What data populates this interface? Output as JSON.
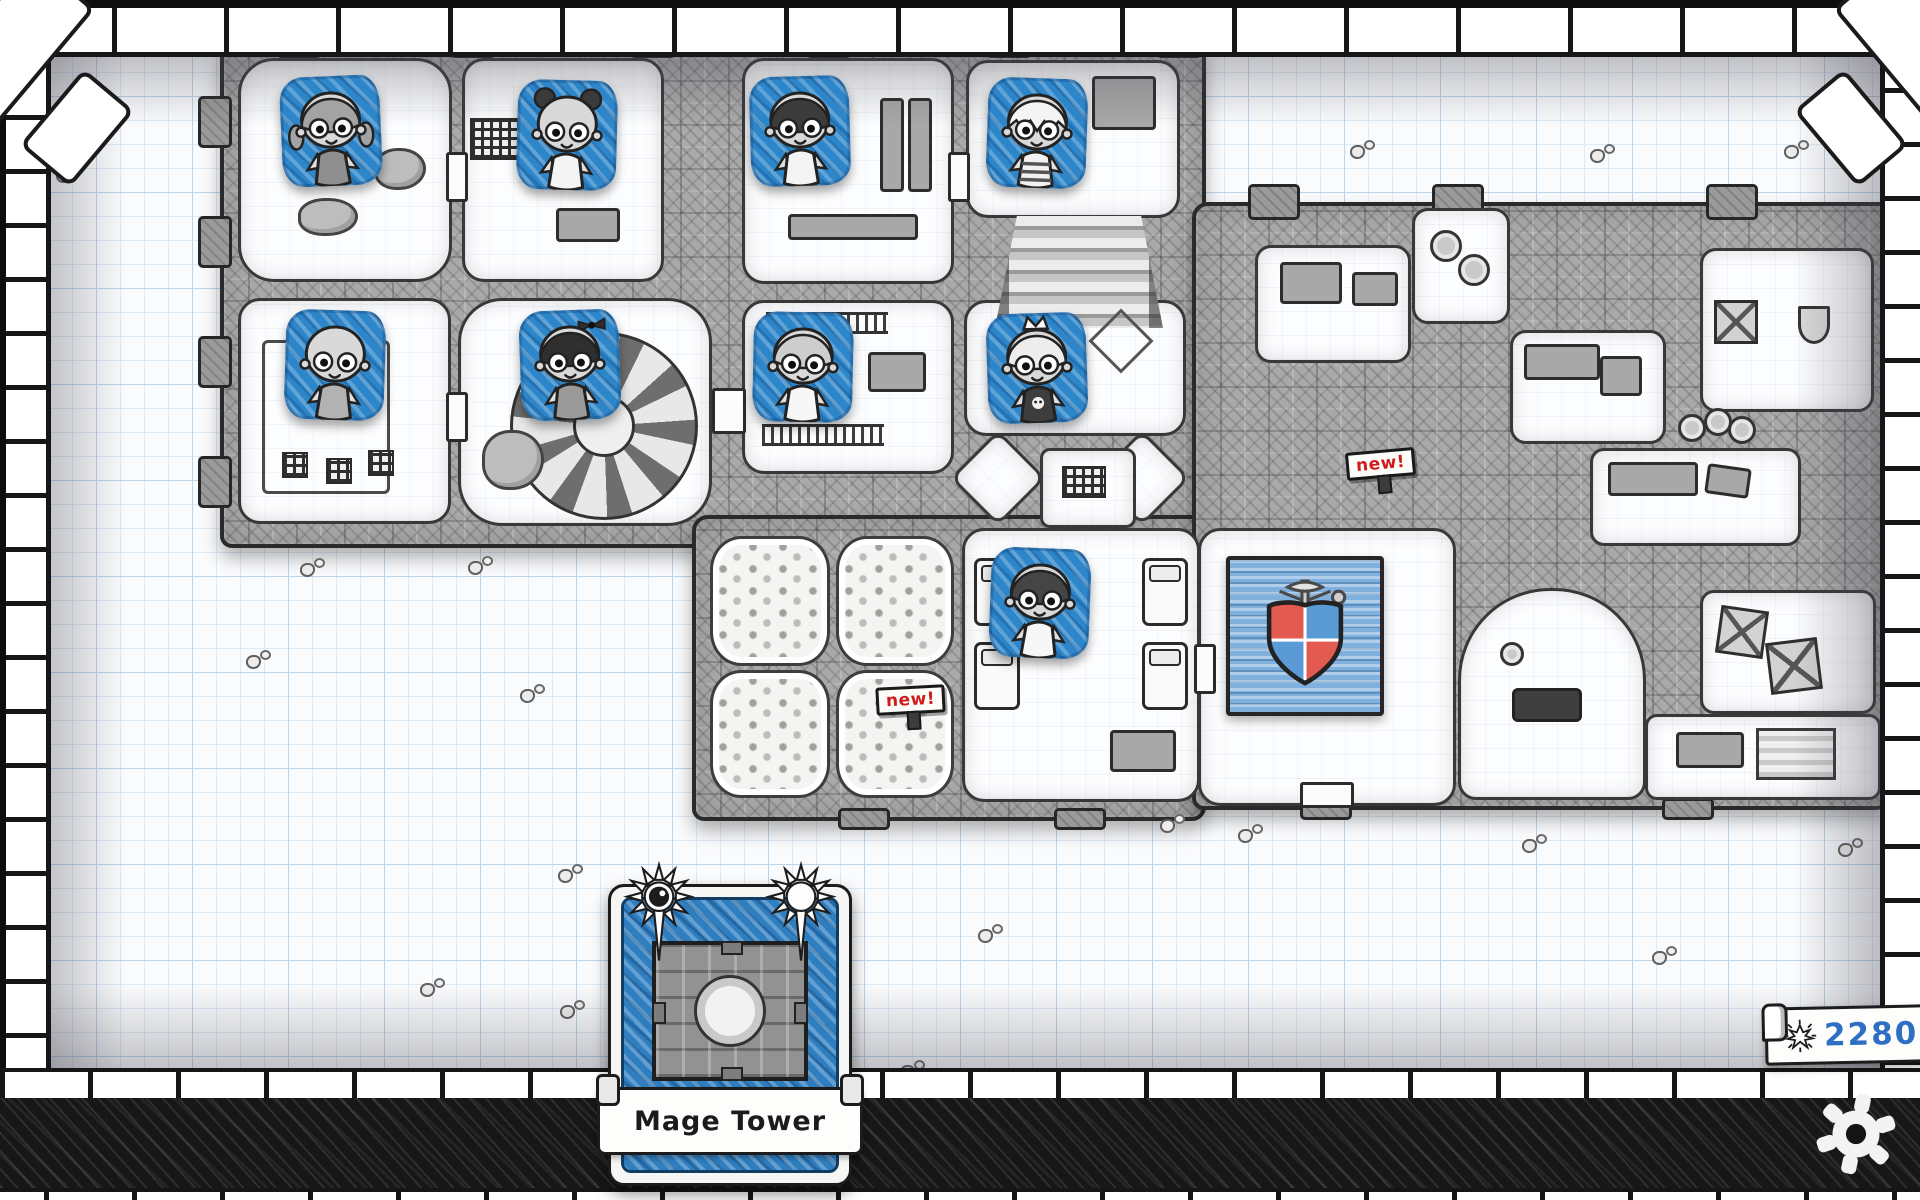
{
  "app": {
    "name": "guild-map-screen"
  },
  "hud": {
    "selected_card": {
      "label": "Mage Tower"
    },
    "currency": {
      "value": "2280",
      "icon": "spark-icon"
    },
    "settings": {
      "icon": "gear-icon"
    }
  },
  "map": {
    "signs": [
      {
        "label": "new!",
        "x": 1346,
        "y": 450,
        "rot": -5
      },
      {
        "label": "new!",
        "x": 876,
        "y": 686,
        "rot": -3
      }
    ],
    "crest": {
      "quarter_colors": [
        "#e25a50",
        "#5b9bd5",
        "#5b9bd5",
        "#e25a50"
      ],
      "banner_color": "#7fb0de"
    }
  },
  "roster": [
    {
      "name": "hero-grey-bob-girl",
      "hair": "gray-bob",
      "outfit": "#8f8f8f",
      "x": 281,
      "y": 76
    },
    {
      "name": "hero-mouse-ears-girl",
      "hair": "mouse-ears",
      "outfit": "#f4f4f4",
      "x": 517,
      "y": 80
    },
    {
      "name": "hero-dark-messy-boy",
      "hair": "dark-messy",
      "outfit": "#f4f4f4",
      "x": 750,
      "y": 76
    },
    {
      "name": "hero-white-spiky-boy",
      "hair": "white-spiky",
      "outfit": "stripes",
      "x": 987,
      "y": 78
    },
    {
      "name": "hero-bald-kid",
      "hair": "bald",
      "outfit": "#b2b2b2",
      "x": 285,
      "y": 310
    },
    {
      "name": "hero-black-bob-girl",
      "hair": "black-bob-bow",
      "outfit": "#9a9a9a",
      "x": 520,
      "y": 310
    },
    {
      "name": "hero-grey-side-boy",
      "hair": "gray-side",
      "outfit": "#f7f7f7",
      "x": 753,
      "y": 312
    },
    {
      "name": "hero-crowned-kid",
      "hair": "white-crown",
      "outfit": "#3d3d3d",
      "emblem": "skull",
      "x": 987,
      "y": 313
    },
    {
      "name": "hero-dark-neat-boy",
      "hair": "dark-neat",
      "outfit": "#f7f7f7",
      "x": 990,
      "y": 548
    }
  ],
  "pebbles": [
    {
      "x": 56,
      "y": 164
    },
    {
      "x": 1350,
      "y": 140
    },
    {
      "x": 1590,
      "y": 144
    },
    {
      "x": 1784,
      "y": 140
    },
    {
      "x": 246,
      "y": 650
    },
    {
      "x": 300,
      "y": 558
    },
    {
      "x": 468,
      "y": 556
    },
    {
      "x": 520,
      "y": 684
    },
    {
      "x": 558,
      "y": 864
    },
    {
      "x": 900,
      "y": 1060
    },
    {
      "x": 978,
      "y": 924
    },
    {
      "x": 1160,
      "y": 814
    },
    {
      "x": 1238,
      "y": 824
    },
    {
      "x": 1522,
      "y": 834
    },
    {
      "x": 1652,
      "y": 946
    },
    {
      "x": 1838,
      "y": 838
    },
    {
      "x": 420,
      "y": 978
    },
    {
      "x": 560,
      "y": 1000
    }
  ],
  "colors": {
    "tile_blue": "#2e86ca",
    "ink": "#1c1c1c",
    "badge_red": "#cf1d1d",
    "currency_blue": "#2d6fc3",
    "paper": "#fafbfd",
    "grid_minor": "#dce9f6",
    "grid_major": "#bcd4ec"
  }
}
